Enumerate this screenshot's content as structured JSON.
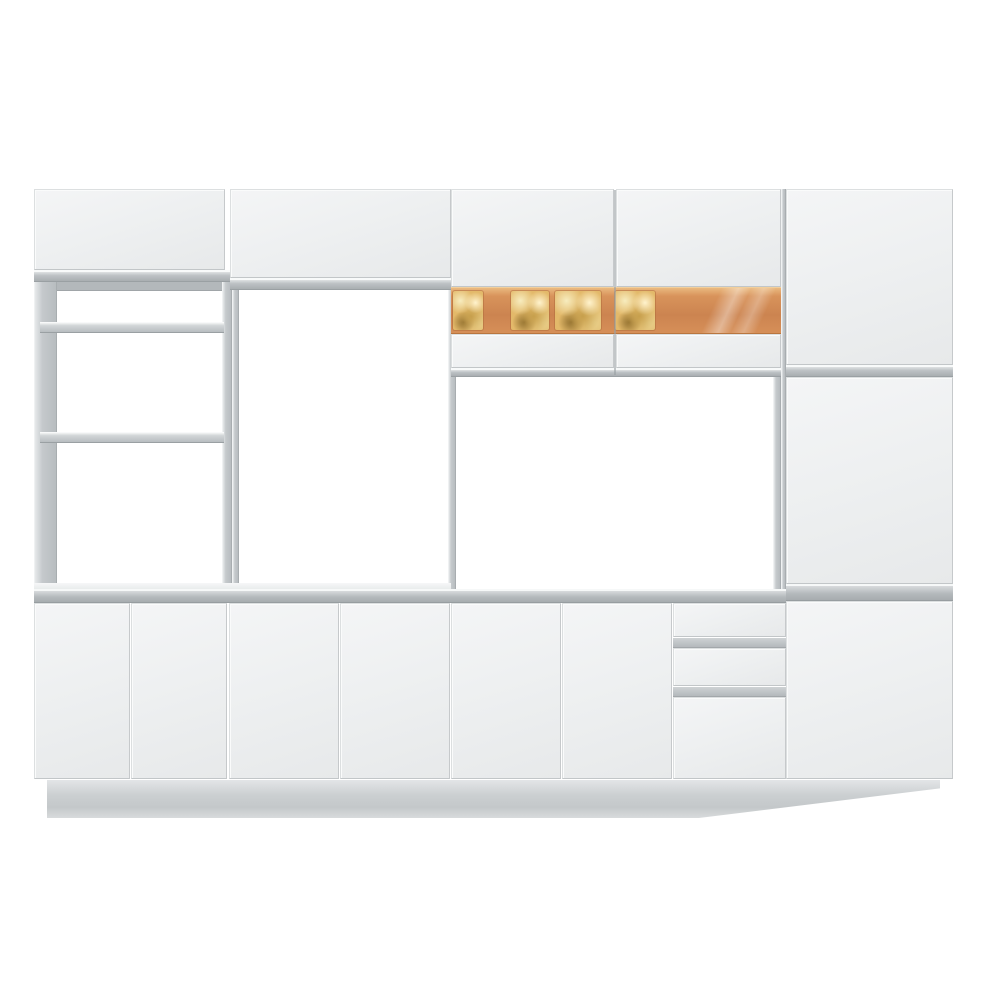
{
  "image": {
    "description": "white-modular-kitchen-cabinet-set-product-photo",
    "text_content": []
  },
  "palette": {
    "background": "#ffffff",
    "door_face_light": "#f4f5f6",
    "door_face_dark": "#e7e9ea",
    "edge_band_grey": "#b9bec1",
    "deep_line_grey": "#9aa0a3",
    "stile_grey": "#c2c6c9",
    "countertop_grey": "#aeb3b6",
    "glass_light": "#eab97f",
    "glass_mid": "#d8935b",
    "glass_deep": "#cc8450",
    "pane_gold": "#e3b96a",
    "plinth_grey": "#cdd1d3"
  },
  "scene": {
    "width": 1000,
    "height": 1000,
    "blocks": [
      {
        "name": "left-unit-top-door",
        "kind": "door",
        "x": 34,
        "y": 189,
        "w": 191,
        "h": 81
      },
      {
        "name": "left-unit-top-edge-band",
        "kind": "band",
        "x": 34,
        "y": 270,
        "w": 198,
        "h": 12
      },
      {
        "name": "left-unit-frame-bar",
        "kind": "band2",
        "x": 38,
        "y": 282,
        "w": 190,
        "h": 9
      },
      {
        "name": "left-unit-left-stile",
        "kind": "stile",
        "x": 34,
        "y": 282,
        "w": 23,
        "h": 307
      },
      {
        "name": "left-unit-right-stile",
        "kind": "stile",
        "x": 222,
        "y": 282,
        "w": 10,
        "h": 307
      },
      {
        "name": "left-unit-shelf-upper",
        "kind": "shelf",
        "x": 40,
        "y": 322,
        "w": 184,
        "h": 11
      },
      {
        "name": "left-unit-shelf-lower",
        "kind": "shelf",
        "x": 40,
        "y": 432,
        "w": 184,
        "h": 11
      },
      {
        "name": "tower-top-door",
        "kind": "door",
        "x": 230,
        "y": 189,
        "w": 221,
        "h": 89
      },
      {
        "name": "tower-top-edge-band",
        "kind": "band",
        "x": 230,
        "y": 278,
        "w": 221,
        "h": 12
      },
      {
        "name": "tower-left-stile",
        "kind": "stile",
        "x": 232,
        "y": 290,
        "w": 7,
        "h": 299
      },
      {
        "name": "tower-right-stile",
        "kind": "stile",
        "x": 448,
        "y": 290,
        "w": 8,
        "h": 299
      },
      {
        "name": "wall-cabinet-left-door-upper",
        "kind": "door",
        "x": 451,
        "y": 189,
        "w": 163,
        "h": 98
      },
      {
        "name": "wall-cabinet-right-door-upper",
        "kind": "door",
        "x": 616,
        "y": 189,
        "w": 165,
        "h": 98
      },
      {
        "name": "wall-cabinet-glass-band",
        "kind": "glass",
        "x": 451,
        "y": 287,
        "w": 330,
        "h": 47
      },
      {
        "name": "glass-pane-1",
        "kind": "glass-pane",
        "x": 453,
        "y": 291,
        "w": 30,
        "h": 39
      },
      {
        "name": "glass-pane-2",
        "kind": "glass-pane",
        "x": 511,
        "y": 291,
        "w": 38,
        "h": 39
      },
      {
        "name": "glass-pane-3",
        "kind": "glass-pane",
        "x": 555,
        "y": 291,
        "w": 46,
        "h": 39
      },
      {
        "name": "glass-pane-4",
        "kind": "glass-pane",
        "x": 615,
        "y": 291,
        "w": 40,
        "h": 39
      },
      {
        "name": "glass-reflection-streak",
        "kind": "glass-streak",
        "x": 690,
        "y": 288,
        "w": 85,
        "h": 45
      },
      {
        "name": "wall-cabinet-left-door-lower",
        "kind": "door",
        "x": 451,
        "y": 334,
        "w": 163,
        "h": 34
      },
      {
        "name": "wall-cabinet-right-door-lower",
        "kind": "door",
        "x": 616,
        "y": 334,
        "w": 165,
        "h": 34
      },
      {
        "name": "wall-cabinet-bottom-band",
        "kind": "band",
        "x": 451,
        "y": 368,
        "w": 330,
        "h": 9
      },
      {
        "name": "wall-cabinet-door-divider",
        "kind": "divider-v",
        "x": 614,
        "y": 190,
        "w": 2,
        "h": 185
      },
      {
        "name": "tall-cabinet-side-stile",
        "kind": "stile",
        "x": 781,
        "y": 189,
        "w": 5,
        "h": 590
      },
      {
        "name": "tall-cabinet-door-top",
        "kind": "door",
        "x": 786,
        "y": 189,
        "w": 167,
        "h": 176
      },
      {
        "name": "tall-cabinet-divider-upper",
        "kind": "band",
        "x": 786,
        "y": 365,
        "w": 167,
        "h": 12
      },
      {
        "name": "tall-cabinet-door-middle",
        "kind": "door",
        "x": 786,
        "y": 377,
        "w": 167,
        "h": 207
      },
      {
        "name": "tall-cabinet-divider-lower",
        "kind": "counter",
        "x": 786,
        "y": 584,
        "w": 167,
        "h": 17
      },
      {
        "name": "tall-cabinet-door-bottom",
        "kind": "door",
        "x": 786,
        "y": 601,
        "w": 167,
        "h": 178
      },
      {
        "name": "work-area-side-panel",
        "kind": "stile",
        "x": 773,
        "y": 377,
        "w": 8,
        "h": 212
      },
      {
        "name": "countertop-ledge",
        "kind": "ledge",
        "x": 34,
        "y": 583,
        "w": 417,
        "h": 6
      },
      {
        "name": "countertop",
        "kind": "counter",
        "x": 34,
        "y": 589,
        "w": 752,
        "h": 14
      },
      {
        "name": "base-door-1",
        "kind": "door",
        "x": 34,
        "y": 603,
        "w": 96,
        "h": 176
      },
      {
        "name": "base-door-2",
        "kind": "door",
        "x": 131,
        "y": 603,
        "w": 96,
        "h": 176
      },
      {
        "name": "base-door-3",
        "kind": "door",
        "x": 229,
        "y": 603,
        "w": 110,
        "h": 176
      },
      {
        "name": "base-door-4",
        "kind": "door",
        "x": 340,
        "y": 603,
        "w": 110,
        "h": 176
      },
      {
        "name": "base-door-5",
        "kind": "door",
        "x": 451,
        "y": 603,
        "w": 110,
        "h": 176
      },
      {
        "name": "base-door-6",
        "kind": "door",
        "x": 562,
        "y": 603,
        "w": 110,
        "h": 176
      },
      {
        "name": "drawer-front-top",
        "kind": "door",
        "x": 673,
        "y": 603,
        "w": 113,
        "h": 34
      },
      {
        "name": "drawer-groove-1",
        "kind": "groove",
        "x": 673,
        "y": 637,
        "w": 113,
        "h": 11
      },
      {
        "name": "drawer-front-middle",
        "kind": "door",
        "x": 673,
        "y": 648,
        "w": 113,
        "h": 38
      },
      {
        "name": "drawer-groove-2",
        "kind": "groove",
        "x": 673,
        "y": 686,
        "w": 113,
        "h": 11
      },
      {
        "name": "drawer-base-door",
        "kind": "door",
        "x": 673,
        "y": 697,
        "w": 113,
        "h": 82
      },
      {
        "name": "plinth",
        "kind": "plinth",
        "x": 47,
        "y": 780,
        "w": 893,
        "h": 38
      }
    ]
  }
}
